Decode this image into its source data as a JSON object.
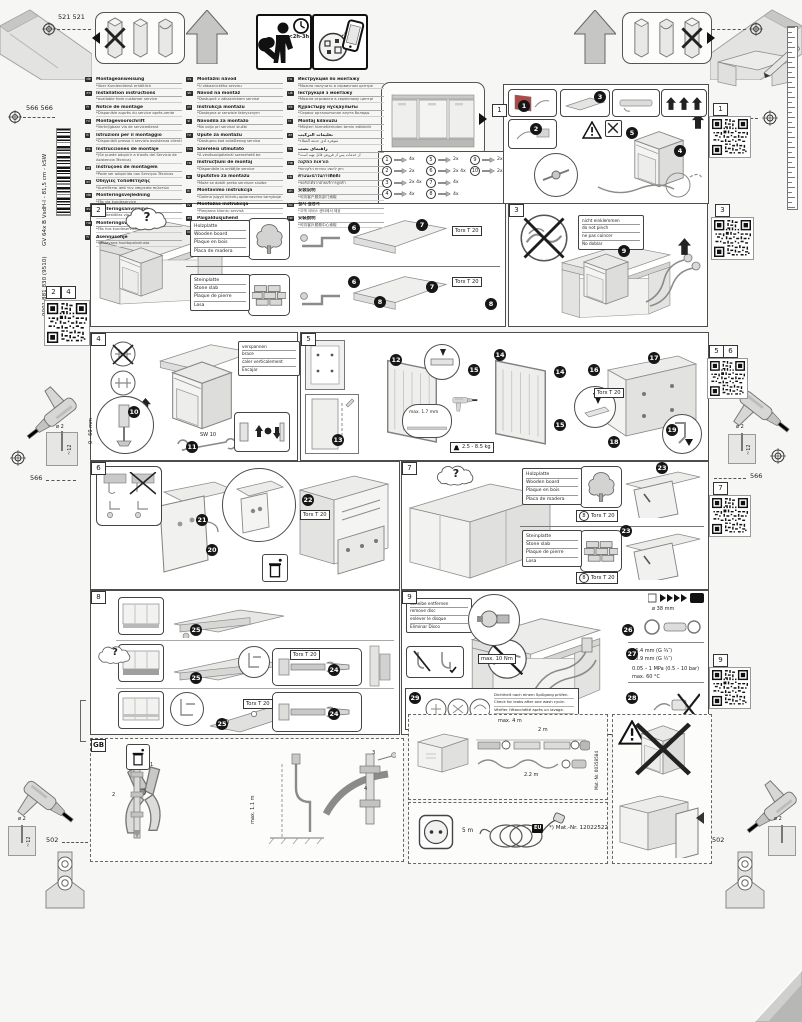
{
  "meta": {
    "dim_a": "521 521",
    "dim_b": "566 566",
    "dim_c": "566",
    "dim_d": "502",
    "barcode_text": "GV 64x B VsdH-I - 81,5 cm - kSW",
    "barcode_number": "9001 881 830 (9510)",
    "install_time": "<2h-3h",
    "drill_dia": "ø 2",
    "drill_depth": "~12"
  },
  "qr_labels": {
    "left_a": "2",
    "left_b": "4",
    "r1": "1",
    "r3": "3",
    "r5": "5",
    "r6": "6",
    "r7": "7",
    "r9": "9"
  },
  "languages": {
    "col1": [
      {
        "code": "de",
        "title": "Montageanweisung",
        "note": "*über Kundendienst erhältlich"
      },
      {
        "code": "en",
        "title": "Installation instructions",
        "note": "*available from customer service"
      },
      {
        "code": "fr",
        "title": "Notice de montage",
        "note": "*Disponible auprès du service après-vente"
      },
      {
        "code": "nl",
        "title": "Montagevoorschrift",
        "note": "*Verkrijgbaar via de servicedienst"
      },
      {
        "code": "it",
        "title": "Istruzioni per il montaggio",
        "note": "*Disponibili presso il servizio assistenza clienti"
      },
      {
        "code": "es",
        "title": "Instrucciones de montaje",
        "note": "*(Se puede adquirir a través del Servicio de Asistencia Técnica)"
      },
      {
        "code": "pt",
        "title": "Instruções de montagem",
        "note": "*Pode ser adquirido nos Serviços Técnicos"
      },
      {
        "code": "el",
        "title": "Οδηγίες τοποθέτησης",
        "note": "*Διατίθεται από την υπηρεσία πελατών"
      },
      {
        "code": "da",
        "title": "Monteringsvejledning",
        "note": "*Fås via kundeservice"
      },
      {
        "code": "sv",
        "title": "Monteringsanvisning",
        "note": "*Kan beställas via kundtjänst"
      },
      {
        "code": "no",
        "title": "Monteringsveiledning",
        "note": "*Fås hos kundeservice"
      },
      {
        "code": "fi",
        "title": "Asennusohje",
        "note": "*Saatavana huoltopalvelusta"
      }
    ],
    "col2": [
      {
        "code": "cs",
        "title": "Montážní návod",
        "note": "*U zákaznického servisu"
      },
      {
        "code": "sk",
        "title": "Návod na montáž",
        "note": "*Dostupné v zákazníckom servise"
      },
      {
        "code": "pl",
        "title": "Instrukcja montażu",
        "note": "*Dostępna w serwisie fabrycznym"
      },
      {
        "code": "sl",
        "title": "Navodila za montažo",
        "note": "*Na voljo pri servisni službi"
      },
      {
        "code": "hr",
        "title": "Upute za montažu",
        "note": "*Dostupno kod ovlaštenog servisa"
      },
      {
        "code": "hu",
        "title": "Szerelési útmutató",
        "note": "*A vevőszolgálatnál szerezhető be"
      },
      {
        "code": "ro",
        "title": "Instrucţiuni de montaj",
        "note": "*Disponibile la unităţile service"
      },
      {
        "code": "sr",
        "title": "Uputstvo za montažu",
        "note": "*Može se dobiti preko servisne službe"
      },
      {
        "code": "lt",
        "title": "Montavimo instrukcija",
        "note": "*Galima įsigyti klientų aptarnavimo tarnyboje"
      },
      {
        "code": "lv",
        "title": "Montāžas instrukcija",
        "note": "*Pieejama klientu servisā"
      },
      {
        "code": "et",
        "title": "Paigaldusjuhend",
        "note": "*Saadaval klienditeenindusest"
      },
      {
        "code": "bg",
        "title": "Инструкция за монтаж",
        "note": "*Получава се от сервизната служба"
      }
    ],
    "col3": [
      {
        "code": "ru",
        "title": "Инструкция по монтажу",
        "note": "*Можно получить в сервисном центре"
      },
      {
        "code": "uk",
        "title": "Інструкція з монтажу",
        "note": "*Можна отримати в сервісному центрі"
      },
      {
        "code": "kk",
        "title": "Құрастыру нұсқаулығы",
        "note": "*Сервис орталығынан алуға болады"
      },
      {
        "code": "tr",
        "title": "Montaj kılavuzu",
        "note": "*Müşteri hizmetlerinden temin edilebilir"
      },
      {
        "code": "ar",
        "title": "تعليمات التركيب",
        "note": "*متوفرة لدى خدمة العملاء"
      },
      {
        "code": "fa",
        "title": "راهنمای نصب",
        "note": "*از خدمات پس از فروش قابل تهیه است"
      },
      {
        "code": "he",
        "title": "הוראות התקנה",
        "note": "*ניתן להשיג בשירות הלקוחות"
      },
      {
        "code": "th",
        "title": "คำแนะนำในการติดตั้ง",
        "note": "*ขอรับได้จากฝ่ายบริการลูกค้า"
      },
      {
        "code": "zh",
        "title": "安装说明",
        "note": "*可向客户服务部门索取"
      },
      {
        "code": "ko",
        "title": "설치 설명서",
        "note": "*고객 서비스 센터에서 제공"
      },
      {
        "code": "tw",
        "title": "安裝說明",
        "note": "*可向客戶服務中心索取"
      }
    ]
  },
  "materials": {
    "wood": [
      "Holzplatte",
      "Wooden board",
      "Plaque en bois",
      "Placa de madera"
    ],
    "stone": [
      "Steinplatte",
      "Stone slab",
      "Plaque de pierre",
      "Losa"
    ]
  },
  "panel1": {
    "tag": "1",
    "steps": [
      "1",
      "2",
      "3",
      "4",
      "5"
    ],
    "parts": [
      {
        "num": "1",
        "qty": "4x"
      },
      {
        "num": "2",
        "qty": "2x"
      },
      {
        "num": "3",
        "qty": "2x 4x"
      },
      {
        "num": "4",
        "qty": "4x"
      },
      {
        "num": "5",
        "qty": "2x"
      },
      {
        "num": "6",
        "qty": "2x 4x"
      },
      {
        "num": "7",
        "qty": "4x"
      },
      {
        "num": "8",
        "qty": "4x"
      },
      {
        "num": "9",
        "qty": "2x"
      },
      {
        "num": "10",
        "qty": "2x"
      }
    ]
  },
  "panel2": {
    "tag": "2",
    "question": "?",
    "torx": "Torx T 20",
    "steps": [
      "6",
      "7",
      "8"
    ]
  },
  "panel3": {
    "tag": "3",
    "step": "9",
    "note": [
      "nicht einklemmen",
      "do not pinch",
      "ne pas coincer",
      "No doblar"
    ]
  },
  "panel4": {
    "tag": "4",
    "note": [
      "verspannen",
      "brace",
      "caler verticalement",
      "Encajar"
    ],
    "range": "0 - 60 mm",
    "sw13": "SW 13",
    "sw10": "SW 10",
    "steps": [
      "10",
      "11"
    ]
  },
  "panel5": {
    "tag": "5",
    "steps": [
      "12",
      "13",
      "14",
      "15",
      "16",
      "17",
      "18",
      "19"
    ],
    "gap": "max. 1.7 mm",
    "weight": "2.5 - 8.5 kg",
    "torx": "Torx T 20"
  },
  "panel6": {
    "tag": "6",
    "steps": [
      "20",
      "21",
      "22"
    ],
    "torx": "Torx T 20"
  },
  "panel7": {
    "tag": "7",
    "question": "?",
    "torx": "Torx T 20",
    "part_ref": "8",
    "step": "23"
  },
  "panel8": {
    "tag": "8",
    "question": "?",
    "steps": [
      "24",
      "25"
    ],
    "torx": "Torx T 20"
  },
  "panel9": {
    "tag": "9",
    "note": [
      "Scheibe entfernen",
      "remove disc",
      "enlever le disque",
      "Eliminar Disco"
    ],
    "torque": "max. 10 Nm",
    "steps": [
      "26",
      "27",
      "28",
      "29"
    ],
    "check": [
      "Dichtheit nach einem Spülgang prüfen.",
      "Check for leaks after one wash cycle.",
      "Vérifier l'étanchéité après un lavage.",
      "Verificar la estanqueidad tras un ciclo de lavado."
    ],
    "drain_dia": "ø 38 mm",
    "inlet_a": "26.4 mm (G ¾″)",
    "inlet_b": "20.9 mm (G ½″)",
    "pressure": "0.05 – 1 MPa (0.5 – 10 bar)",
    "temp": "max. 60 °C"
  },
  "panel_gb": {
    "tag": "GB",
    "max_len": "max. 1.1 m",
    "callouts": [
      "1",
      "2",
      "3",
      "4"
    ]
  },
  "hose_box": {
    "len_max": "max. 4 m",
    "len_a": "2 m",
    "len_b": "2.2 m",
    "mat_nr": "Mat.-Nr. 00358584"
  },
  "power_box": {
    "length": "5 m",
    "region": "EU",
    "mat_nr": "*) Mat.-Nr. 12022522"
  }
}
